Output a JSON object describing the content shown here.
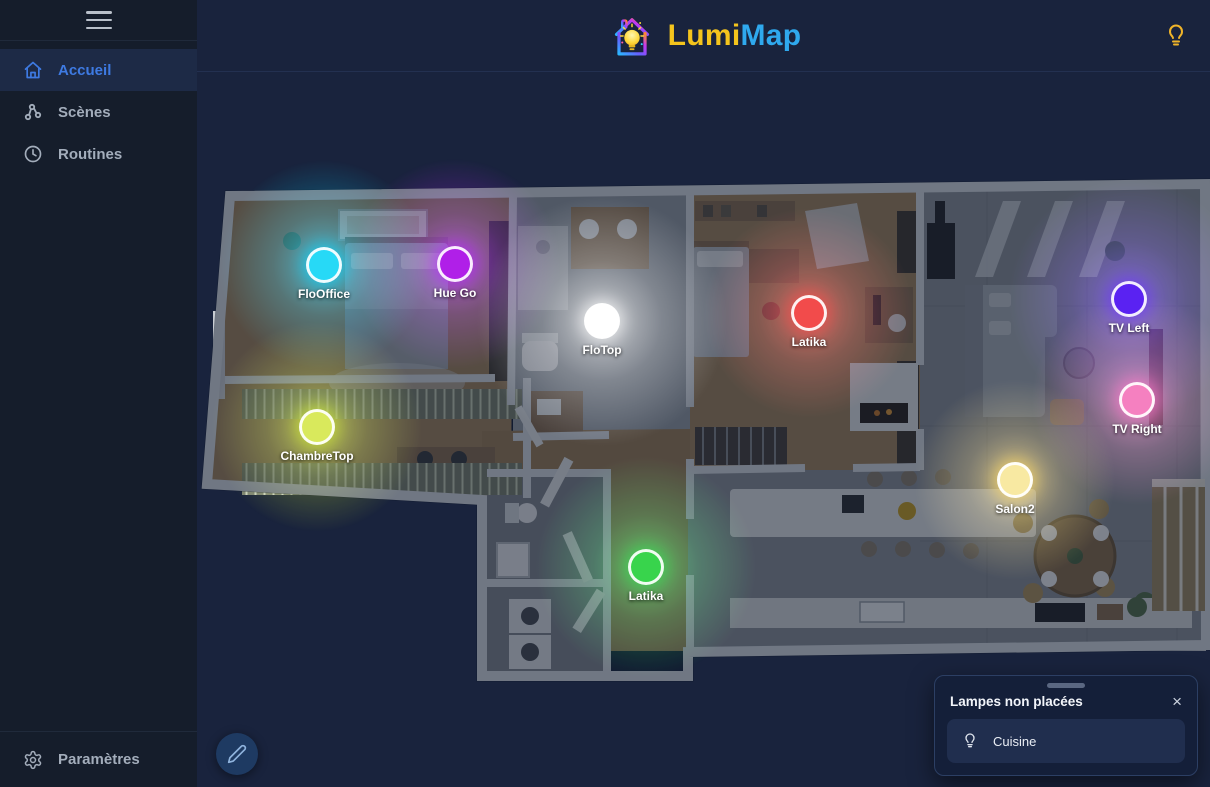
{
  "brand": {
    "part1": "Lumi",
    "part2": "Map",
    "part1_color": "#f4c41d",
    "part2_color": "#2fa9ee"
  },
  "sidebar": {
    "items": [
      {
        "label": "Accueil",
        "active": true
      },
      {
        "label": "Scènes",
        "active": false
      },
      {
        "label": "Routines",
        "active": false
      }
    ],
    "footer": {
      "label": "Paramètres"
    }
  },
  "map": {
    "lights": [
      {
        "label": "FloOffice",
        "color": "#27d9f6",
        "glow_color": "#00d5ff",
        "glow_radius": 105,
        "x": 127,
        "y": 194
      },
      {
        "label": "Hue Go",
        "color": "#b01fe8",
        "glow_color": "#b520ff",
        "glow_radius": 105,
        "x": 258,
        "y": 193
      },
      {
        "label": "FloTop",
        "color": "#ffffff",
        "glow_color": "#ffffff",
        "glow_radius": 125,
        "x": 405,
        "y": 250
      },
      {
        "label": "Latika",
        "color": "#f24b4b",
        "glow_color": "#ff4545",
        "glow_radius": 105,
        "x": 612,
        "y": 242
      },
      {
        "label": "TV Left",
        "color": "#5a22f2",
        "glow_color": "#6a30ff",
        "glow_radius": 120,
        "x": 932,
        "y": 228
      },
      {
        "label": "TV Right",
        "color": "#f580c0",
        "glow_color": "#ff74c8",
        "glow_radius": 105,
        "x": 940,
        "y": 329
      },
      {
        "label": "ChambreTop",
        "color": "#d9e95c",
        "glow_color": "#cde830",
        "glow_radius": 105,
        "x": 120,
        "y": 356
      },
      {
        "label": "Salon2",
        "color": "#f8e9a2",
        "glow_color": "#ffd95e",
        "glow_radius": 100,
        "x": 818,
        "y": 409
      },
      {
        "label": "Latika",
        "color": "#38d44c",
        "glow_color": "#2ee04e",
        "glow_radius": 110,
        "x": 449,
        "y": 496
      }
    ]
  },
  "panel": {
    "title": "Lampes non placées",
    "close_glyph": "×",
    "items": [
      {
        "label": "Cuisine"
      }
    ]
  }
}
